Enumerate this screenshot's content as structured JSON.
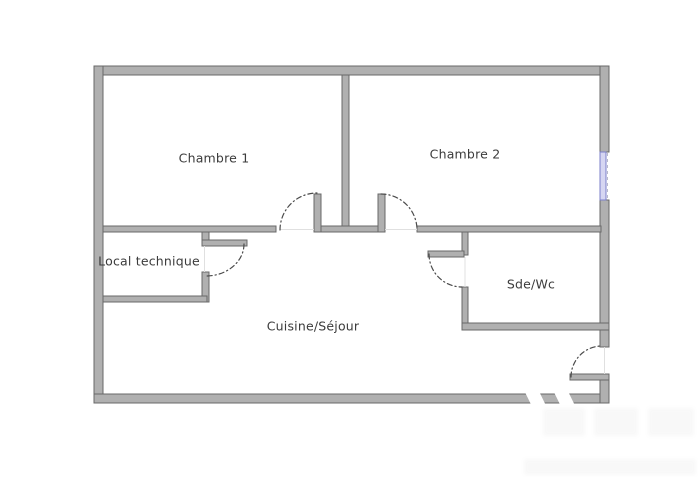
{
  "floorplan": {
    "rooms": [
      {
        "id": "chambre-1",
        "label": "Chambre 1"
      },
      {
        "id": "chambre-2",
        "label": "Chambre 2"
      },
      {
        "id": "local-technique",
        "label": "Local technique"
      },
      {
        "id": "sde-wc",
        "label": "Sde/Wc"
      },
      {
        "id": "cuisine-sejour",
        "label": "Cuisine/Séjour"
      }
    ],
    "colors": {
      "wall_fill": "#b0b0b0",
      "wall_edge": "#686868",
      "window_fill": "#d6d6f2",
      "window_edge": "#7b7fca",
      "door_arc": "#4b4b4b",
      "label_text": "#3b3b3b",
      "background": "#ffffff"
    }
  }
}
